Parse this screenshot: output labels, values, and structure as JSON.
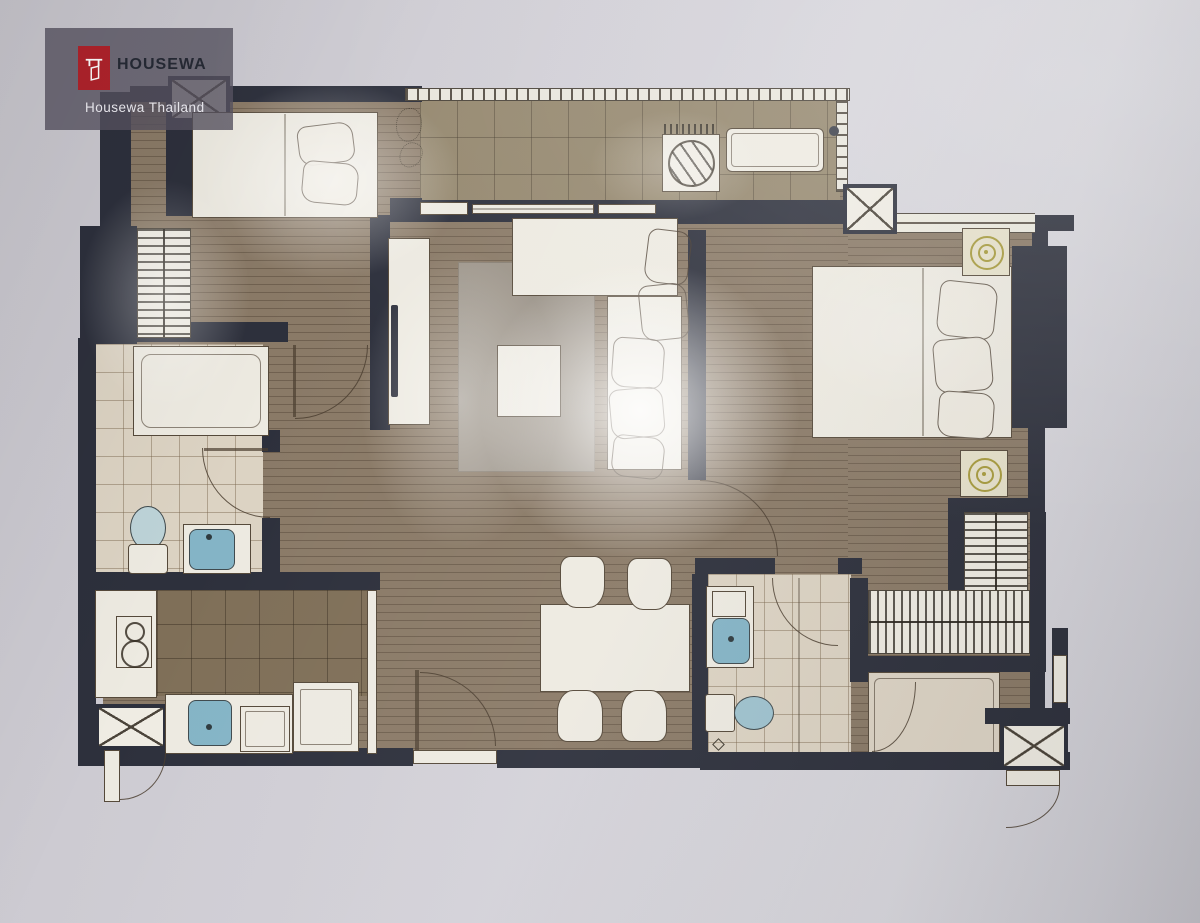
{
  "watermark": {
    "brand": "HOUSEWA",
    "caption": "Housewa Thailand"
  },
  "palette": {
    "paper": "#d1cfd6",
    "wall": "#2d303c",
    "wood": "#8a7a67",
    "balcony_tile": "#95886f",
    "kitchen_tile": "#7f6f58",
    "bath_tile": "#dcd3c3",
    "furniture": "#edeae1",
    "outline": "#55493a",
    "rug": "#9c9489",
    "fixture_blue": "#84b4c6",
    "lamp_gold": "#a79b3c",
    "logo_red": "#b0232b",
    "watermark_bg": "rgba(86,82,96,0.8)"
  },
  "plan": {
    "type": "floor-plan",
    "rooms": [
      {
        "name": "balcony",
        "floor": "tile",
        "items": [
          "ac-condenser-unit",
          "bench",
          "planter",
          "railing",
          "sliding-doors"
        ]
      },
      {
        "name": "bedroom-2",
        "floor": "wood",
        "items": [
          "double-bed",
          "pillows",
          "wardrobe-hanging-rail"
        ]
      },
      {
        "name": "bathroom-2",
        "floor": "tile",
        "items": [
          "bathtub-shower",
          "toilet",
          "washbasin",
          "swing-door"
        ]
      },
      {
        "name": "kitchen",
        "floor": "tile",
        "items": [
          "counter",
          "two-burner-stove",
          "sink",
          "cabinet",
          "refrigerator",
          "sliding-partition",
          "swing-door"
        ]
      },
      {
        "name": "living-room",
        "floor": "wood",
        "items": [
          "tv-console",
          "tv",
          "rug",
          "coffee-table",
          "l-shaped-sofa",
          "cushions"
        ]
      },
      {
        "name": "dining-area",
        "floor": "wood",
        "items": [
          "dining-table",
          "chair",
          "chair",
          "chair",
          "chair"
        ]
      },
      {
        "name": "master-bedroom",
        "floor": "wood",
        "items": [
          "double-bed",
          "pillows",
          "nightstand-lamp",
          "nightstand-lamp",
          "built-in-wardrobe",
          "window"
        ]
      },
      {
        "name": "walk-in-closet",
        "floor": "wood",
        "items": [
          "hanging-rail",
          "hanging-rail"
        ]
      },
      {
        "name": "master-bathroom",
        "floor": "tile",
        "items": [
          "vanity-washbasin",
          "toilet",
          "shower-screen",
          "swing-door"
        ]
      },
      {
        "name": "service-room",
        "floor": "tile",
        "items": [
          "swing-door"
        ]
      },
      {
        "name": "structure",
        "items": [
          "shaft-nw",
          "shaft-balcony-corner",
          "entrance-shaft",
          "service-shaft",
          "entrance-door",
          "service-door"
        ]
      }
    ]
  }
}
